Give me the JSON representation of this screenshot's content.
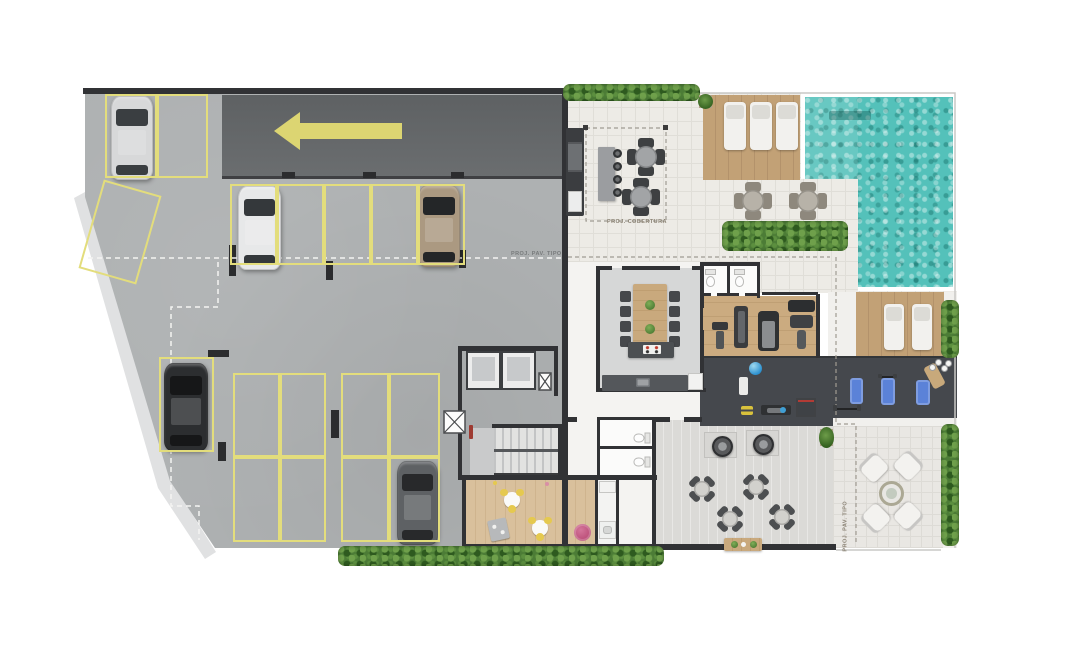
{
  "labels": {
    "cobertura": "PROJ. COBERTURA",
    "pav_tipo": "PROJ. PAV. TIPO"
  },
  "palette": {
    "concrete": "#aeb1b2",
    "drive": "#65686b",
    "curb": "#e0e1e2",
    "yline": "#e3dd7c",
    "wall": "#313235",
    "tile": "#edebe6",
    "tile_grid": "#e0ded8",
    "party": "#d6d7d7",
    "wood": "#c2a176",
    "gymwood": "#cbab80",
    "kidswood": "#d9c09c",
    "darkfloor": "#45484d",
    "pool": "#54c1ba",
    "hedge": "#4c7c36",
    "bluemat": "#5b82d8",
    "pink": "#bf507a",
    "whitefurn": "#f3f2ef",
    "arrow": "#dcd572"
  },
  "items": [
    {
      "t": "car",
      "n": "car-silver",
      "x": 111,
      "y": 96,
      "w": 42,
      "h": 84,
      "body": "#d7d8d9",
      "glass": "#3a3e41"
    },
    {
      "t": "car",
      "n": "car-white",
      "x": 238,
      "y": 186,
      "w": 43,
      "h": 84,
      "body": "#e7e8e9",
      "glass": "#34383b"
    },
    {
      "t": "car",
      "n": "car-tan",
      "x": 418,
      "y": 185,
      "w": 42,
      "h": 82,
      "body": "#ab9981",
      "glass": "#242628"
    },
    {
      "t": "car",
      "n": "car-black",
      "x": 164,
      "y": 363,
      "w": 44,
      "h": 88,
      "body": "#2c2e30",
      "glass": "#161718"
    },
    {
      "t": "car",
      "n": "car-gray",
      "x": 397,
      "y": 461,
      "w": 41,
      "h": 84,
      "body": "#5e6164",
      "glass": "#28292b"
    },
    {
      "t": "spot",
      "n": "parking-spot",
      "x": 105,
      "y": 94,
      "w": 52,
      "h": 84
    },
    {
      "t": "spot",
      "n": "parking-spot",
      "x": 157,
      "y": 94,
      "w": 51,
      "h": 84
    },
    {
      "t": "spot",
      "n": "parking-spot-angled",
      "x": 90,
      "y": 186,
      "w": 60,
      "h": 92,
      "r": 16
    },
    {
      "t": "spot",
      "n": "parking-spot",
      "x": 230,
      "y": 184,
      "w": 47,
      "h": 81
    },
    {
      "t": "spot",
      "n": "parking-spot",
      "x": 277,
      "y": 184,
      "w": 47,
      "h": 81
    },
    {
      "t": "spot",
      "n": "parking-spot",
      "x": 324,
      "y": 184,
      "w": 47,
      "h": 81
    },
    {
      "t": "spot",
      "n": "parking-spot",
      "x": 371,
      "y": 184,
      "w": 47,
      "h": 81
    },
    {
      "t": "spot",
      "n": "parking-spot",
      "x": 418,
      "y": 184,
      "w": 47,
      "h": 81
    },
    {
      "t": "spot",
      "n": "parking-spot",
      "x": 159,
      "y": 357,
      "w": 55,
      "h": 95
    },
    {
      "t": "spot",
      "n": "parking-spot",
      "x": 233,
      "y": 373,
      "w": 47,
      "h": 84
    },
    {
      "t": "spot",
      "n": "parking-spot",
      "x": 280,
      "y": 373,
      "w": 46,
      "h": 84
    },
    {
      "t": "spot",
      "n": "parking-spot",
      "x": 341,
      "y": 373,
      "w": 48,
      "h": 84
    },
    {
      "t": "spot",
      "n": "parking-spot",
      "x": 389,
      "y": 373,
      "w": 51,
      "h": 84
    },
    {
      "t": "spot",
      "n": "parking-spot",
      "x": 233,
      "y": 457,
      "w": 47,
      "h": 85
    },
    {
      "t": "spot",
      "n": "parking-spot",
      "x": 280,
      "y": 457,
      "w": 46,
      "h": 85
    },
    {
      "t": "spot",
      "n": "parking-spot",
      "x": 341,
      "y": 457,
      "w": 48,
      "h": 85
    },
    {
      "t": "spot",
      "n": "parking-spot",
      "x": 389,
      "y": 457,
      "w": 51,
      "h": 85
    },
    {
      "t": "lg",
      "n": "sun-lounger",
      "x": 724,
      "y": 102,
      "w": 22,
      "h": 48
    },
    {
      "t": "lg",
      "n": "sun-lounger",
      "x": 750,
      "y": 102,
      "w": 22,
      "h": 48
    },
    {
      "t": "lg",
      "n": "sun-lounger",
      "x": 776,
      "y": 102,
      "w": 22,
      "h": 48
    },
    {
      "t": "lg",
      "n": "sun-lounger",
      "x": 884,
      "y": 304,
      "w": 20,
      "h": 46
    },
    {
      "t": "lg",
      "n": "sun-lounger",
      "x": 912,
      "y": 304,
      "w": 20,
      "h": 46
    },
    {
      "t": "t4",
      "v": "gray",
      "n": "terrace-table",
      "x": 627,
      "y": 138,
      "w": 38
    },
    {
      "t": "t4",
      "v": "gray",
      "n": "terrace-table",
      "x": 622,
      "y": 178,
      "w": 38
    },
    {
      "t": "t4",
      "v": "taupe",
      "n": "pool-table",
      "x": 734,
      "y": 182,
      "w": 38
    },
    {
      "t": "t4",
      "v": "taupe",
      "n": "pool-table",
      "x": 789,
      "y": 182,
      "w": 38
    },
    {
      "t": "t4",
      "v": "dark",
      "n": "dining-table",
      "x": 688,
      "y": 475,
      "w": 28,
      "r": 45
    },
    {
      "t": "t4",
      "v": "dark",
      "n": "dining-table",
      "x": 742,
      "y": 473,
      "w": 28,
      "r": 45
    },
    {
      "t": "t4",
      "v": "dark",
      "n": "dining-table",
      "x": 716,
      "y": 505,
      "w": 28,
      "r": 45
    },
    {
      "t": "t4",
      "v": "dark",
      "n": "dining-table",
      "x": 768,
      "y": 503,
      "w": 28,
      "r": 45
    },
    {
      "t": "pad",
      "n": "grill-pad",
      "x": 704,
      "y": 432,
      "w": 33,
      "h": 26
    },
    {
      "t": "pad",
      "n": "grill-pad",
      "x": 746,
      "y": 430,
      "w": 33,
      "h": 26
    },
    {
      "t": "grill",
      "n": "round-grill",
      "x": 712,
      "y": 436,
      "w": 21
    },
    {
      "t": "grill",
      "n": "round-grill",
      "x": 753,
      "y": 434,
      "w": 21
    },
    {
      "t": "woodt",
      "n": "buffet-table",
      "x": 724,
      "y": 538,
      "w": 38,
      "h": 13
    },
    {
      "t": "arm",
      "n": "lounge-armchair",
      "x": 862,
      "y": 456,
      "w": 23,
      "r": -45
    },
    {
      "t": "arm",
      "n": "lounge-armchair",
      "x": 897,
      "y": 454,
      "w": 23,
      "r": 45
    },
    {
      "t": "arm",
      "n": "lounge-armchair",
      "x": 864,
      "y": 507,
      "w": 23,
      "r": -135
    },
    {
      "t": "arm",
      "n": "lounge-armchair",
      "x": 897,
      "y": 505,
      "w": 23,
      "r": 135
    },
    {
      "t": "ltable",
      "n": "lounge-fire-table",
      "x": 879,
      "y": 481,
      "w": 25
    },
    {
      "t": "hedge",
      "n": "hedge",
      "x": 563,
      "y": 84,
      "w": 137,
      "h": 17
    },
    {
      "t": "hedge",
      "n": "hedge",
      "x": 722,
      "y": 221,
      "w": 126,
      "h": 30
    },
    {
      "t": "hedge",
      "n": "hedge",
      "x": 941,
      "y": 300,
      "w": 18,
      "h": 58
    },
    {
      "t": "hedge",
      "n": "hedge",
      "x": 338,
      "y": 546,
      "w": 326,
      "h": 20
    },
    {
      "t": "hedge",
      "n": "hedge",
      "x": 941,
      "y": 424,
      "w": 18,
      "h": 122
    },
    {
      "t": "pot",
      "n": "plant-pot",
      "x": 699,
      "y": 95,
      "w": 13,
      "h": 13
    },
    {
      "t": "pot",
      "n": "plant-pot",
      "x": 820,
      "y": 429,
      "w": 13,
      "h": 17
    },
    {
      "t": "matb",
      "n": "exercise-mat-blue",
      "x": 850,
      "y": 378,
      "w": 13,
      "h": 26
    },
    {
      "t": "matb",
      "n": "exercise-mat-blue",
      "x": 881,
      "y": 378,
      "w": 14,
      "h": 27
    },
    {
      "t": "matb",
      "n": "exercise-mat-blue",
      "x": 916,
      "y": 380,
      "w": 14,
      "h": 25
    },
    {
      "t": "matt",
      "n": "exercise-mat-tan",
      "x": 928,
      "y": 364,
      "w": 13,
      "h": 24,
      "r": -28
    },
    {
      "t": "matw",
      "n": "exercise-mat-white",
      "x": 739,
      "y": 377,
      "w": 9,
      "h": 18
    },
    {
      "t": "wts",
      "n": "free-weights",
      "x": 930,
      "y": 360,
      "w": 20,
      "h": 13
    },
    {
      "t": "barbell",
      "n": "barbell",
      "x": 833,
      "y": 404,
      "w": 28,
      "h": 8
    },
    {
      "t": "barbell",
      "n": "barbell",
      "x": 878,
      "y": 373,
      "w": 19,
      "h": 6
    },
    {
      "t": "ball",
      "n": "exercise-ball",
      "x": 749,
      "y": 362,
      "w": 13
    },
    {
      "t": "dmb",
      "n": "dumbbells-yellow",
      "x": 741,
      "y": 406,
      "w": 12,
      "h": 9
    },
    {
      "t": "bench",
      "n": "weight-bench",
      "x": 761,
      "y": 405,
      "w": 30,
      "h": 10
    },
    {
      "t": "rack",
      "n": "squat-rack",
      "x": 796,
      "y": 398,
      "w": 20,
      "h": 19
    },
    {
      "t": "dot",
      "n": "kettlebell-blue",
      "x": 780,
      "y": 407,
      "w": 6,
      "c": "#3f9fd4"
    },
    {
      "t": "mach",
      "v": "a",
      "n": "gym-machine-rack",
      "x": 712,
      "y": 322,
      "w": 16,
      "h": 27
    },
    {
      "t": "mach",
      "v": "b",
      "n": "gym-machine-tower",
      "x": 734,
      "y": 306,
      "w": 14,
      "h": 42
    },
    {
      "t": "mach",
      "v": "c",
      "n": "gym-treadmill",
      "x": 758,
      "y": 311,
      "w": 21,
      "h": 40
    },
    {
      "t": "mach",
      "v": "d",
      "n": "gym-multi-station",
      "x": 788,
      "y": 300,
      "w": 27,
      "h": 50
    },
    {
      "t": "barc",
      "n": "bar-counter",
      "x": 598,
      "y": 147,
      "w": 17,
      "h": 54
    },
    {
      "t": "stool",
      "n": "bar-stool",
      "x": 613,
      "y": 149,
      "w": 9
    },
    {
      "t": "stool",
      "n": "bar-stool",
      "x": 613,
      "y": 162,
      "w": 9
    },
    {
      "t": "stool",
      "n": "bar-stool",
      "x": 613,
      "y": 175,
      "w": 9
    },
    {
      "t": "stool",
      "n": "bar-stool",
      "x": 613,
      "y": 188,
      "w": 9
    },
    {
      "t": "grillcol",
      "n": "bbq-counter",
      "x": 566,
      "y": 128,
      "w": 18,
      "h": 88
    },
    {
      "t": "ltab",
      "n": "party-dining-table",
      "x": 620,
      "y": 284,
      "w": 60,
      "h": 66
    },
    {
      "t": "island",
      "n": "kitchen-island",
      "x": 628,
      "y": 342,
      "w": 46,
      "h": 16
    },
    {
      "t": "counter",
      "n": "kitchen-counter",
      "x": 602,
      "y": 375,
      "w": 86,
      "h": 16
    },
    {
      "t": "fridge",
      "n": "refrigerator",
      "x": 688,
      "y": 373,
      "w": 15,
      "h": 17
    },
    {
      "t": "fridge",
      "n": "refrigerator",
      "x": 599,
      "y": 481,
      "w": 17,
      "h": 12
    },
    {
      "t": "sinkk",
      "n": "laundry-sink",
      "x": 599,
      "y": 521,
      "w": 17,
      "h": 18
    },
    {
      "t": "wc",
      "n": "toilet",
      "x": 704,
      "y": 269,
      "w": 13,
      "h": 19
    },
    {
      "t": "wc",
      "n": "toilet",
      "x": 733,
      "y": 269,
      "w": 13,
      "h": 19
    },
    {
      "t": "wc",
      "n": "toilet",
      "x": 635,
      "y": 429,
      "w": 13,
      "h": 18,
      "r": 90
    },
    {
      "t": "wc",
      "n": "toilet",
      "x": 635,
      "y": 453,
      "w": 13,
      "h": 18,
      "r": 90
    },
    {
      "t": "kidt",
      "n": "kids-table",
      "x": 501,
      "y": 489,
      "w": 22
    },
    {
      "t": "kidt",
      "n": "kids-table",
      "x": 529,
      "y": 517,
      "w": 22
    },
    {
      "t": "toybox",
      "n": "toy-box",
      "x": 489,
      "y": 519,
      "w": 19,
      "h": 21,
      "r": -12
    },
    {
      "t": "pouf",
      "n": "pink-pouf",
      "x": 574,
      "y": 524,
      "w": 17
    },
    {
      "t": "dot",
      "n": "kids-decor",
      "x": 545,
      "y": 482,
      "w": 4,
      "c": "#d98fa6"
    },
    {
      "t": "dot",
      "n": "kids-decor",
      "x": 493,
      "y": 481,
      "w": 4,
      "c": "#e5c94f"
    },
    {
      "t": "ext",
      "n": "fire-extinguisher",
      "x": 469,
      "y": 425,
      "w": 4,
      "h": 14
    },
    {
      "t": "label",
      "v": "",
      "n": "label-proj-cobertura",
      "bind": "labels.cobertura",
      "x": 607,
      "y": 219,
      "c": "#8b8375"
    },
    {
      "t": "label",
      "v": "",
      "n": "label-proj-pav-tipo",
      "bind": "labels.pav_tipo",
      "x": 511,
      "y": 251,
      "c": "#777a7b"
    },
    {
      "t": "label",
      "v": "vert",
      "n": "label-proj-pav-tipo-vertical",
      "bind": "labels.pav_tipo",
      "x": 849,
      "y": 545,
      "r": -90,
      "c": "#8b8375"
    }
  ]
}
